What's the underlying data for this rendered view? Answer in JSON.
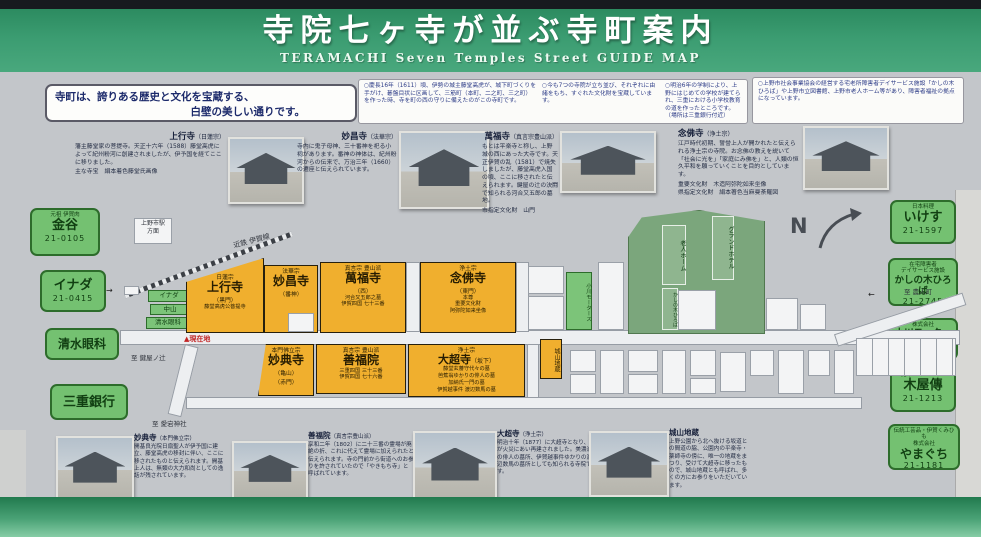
{
  "header": {
    "title": "寺院七ヶ寺が並ぶ寺町案内",
    "subtitle": "TERAMACHI Seven Temples Street GUIDE MAP"
  },
  "intro": {
    "line1": "寺町は、誇りある歴史と文化を宝蔵する、",
    "line2": "白壁の美しい通りです。"
  },
  "notes": {
    "note1": "○慶長16年（1611）頃、伊勢の城主藤堂高虎が、城下町づくりを手がけ、碁盤目状に区画して、三筋町（本町、二之町、三之町）を作った時、寺を町の西の守りに備えたのがこの寺町です。",
    "note2": "○今も7つの寺院が立ち並び、それぞれに由緒をもち、すぐれた文化財を宝蔵しています。",
    "note3": "○明治6年の学制により、上野にはじめての学校が建てられ、三重における小学校教育の道を作ったところです。（場所は三重銀行付近）",
    "note4": "○上野市社会事業協会の経営する宅老所障害者デイサービス施設「かしの木ひろば」や上野市立図書館、上野市老人ホーム等があり、障害者福祉の拠点になっています。"
  },
  "descriptions": [
    {
      "name": "上行寺",
      "sect": "（日蓮宗）",
      "body": "藩主藤堂家の菩提寺。天正十六年（1588）藤堂高虎によって紀州粉河に創建されましたが、伊予国を経てここに移りました。",
      "extra": "主な寺宝　絹本着色藤堂氏画像"
    },
    {
      "name": "妙昌寺",
      "sect": "（法華宗）",
      "body": "寺内に鬼子母神、三十番神を祀る小祠があります。番神の神体は、紀州粉河からの伝来で、万治三年（1660）の遷座と伝えられています。",
      "extra": ""
    },
    {
      "name": "萬福寺",
      "sect": "（真言宗豊山派）",
      "body": "もとは平楽寺と称し、上野城の西にあった大寺です。天正伊賀の乱（1581）で焼失しましたが、藤堂高虎入国の頃、ここに移されたと伝えられます。鍵屋の辻の決闘で知られる河合又五郎の墓地。",
      "extra": "市指定文化財　山門"
    },
    {
      "name": "念佛寺",
      "sect": "（浄土宗）",
      "body": "江戸時代初期、誓誉上人が開かれたと伝えられる浄土宗の寺院。お念佛の教えを説いて「社会に光を」「家庭にみ佛を」と、人類の恒久平和を願っていくことを目的としています。",
      "extra": "重要文化財　木造阿弥陀如来坐像\n県指定文化財　絹本著色当麻曼荼羅図"
    }
  ],
  "left_signs": [
    {
      "tag": "元祖 伊賀肉",
      "name": "金谷",
      "phone": "21-0105"
    },
    {
      "tag": "",
      "name": "イナダ",
      "phone": "21-0415"
    },
    {
      "tag": "",
      "name": "清水眼科",
      "phone": ""
    },
    {
      "tag": "",
      "name": "三重銀行",
      "phone": ""
    }
  ],
  "right_signs": [
    {
      "tag": "日本料理",
      "name": "いけす",
      "phone": "21-1597"
    },
    {
      "tag": "在宅障害者\nデイサービス施設",
      "name": "かしの木ひろば",
      "phone": "21-2745"
    },
    {
      "tag": "株式会社",
      "name": "小川モータース",
      "phone": "21-2625"
    },
    {
      "tag": "銘木・マンション",
      "name": "木屋傳",
      "phone": "21-1213"
    },
    {
      "tag": "伝統工芸品・伊賀くみひも\n株式会社",
      "name": "やまぐち",
      "phone": "21-1181"
    }
  ],
  "map": {
    "railway_label": "近鉄 伊賀線",
    "railway_dest": "上野市駅\n方面",
    "north": "N",
    "you_are_here": "▲現在地",
    "dir_west": "至 鍵屋ノ辻",
    "dir_south": "至 愛宕神社",
    "dir_east": "至 農人町",
    "blocks": {
      "jogyoji": {
        "sect": "日蓮宗",
        "name": "上行寺",
        "note": "（黒門）",
        "note2": "藤堂高虎公菩提寺"
      },
      "myoshoji": {
        "sect": "法華宗",
        "name": "妙昌寺",
        "note": "（番神）",
        "note2": ""
      },
      "manpukuji": {
        "sect": "真言宗 豊山派",
        "name": "萬福寺",
        "note": "（西）",
        "note2": "河合又五郎之墓\n伊賀四国 七十三番"
      },
      "nenbutsuji": {
        "sect": "浄土宗",
        "name": "念佛寺",
        "note": "（東門）",
        "note2": "本尊\n重要文化財\n阿弥陀如来坐像"
      },
      "myotenji": {
        "sect": "本門佛立宗",
        "name": "妙典寺",
        "note": "（亀山）",
        "note2": "（赤門）"
      },
      "zenpukuin": {
        "sect": "真言宗 豊山派",
        "name": "善福院",
        "note": "（京殿）",
        "note2": "三重四国 三十三番\n伊賀四国 七十六番"
      },
      "daichoji": {
        "sect": "浄土宗",
        "name": "大超寺",
        "note": "（坂下）",
        "note2": "藤堂玄蕃守代々の墓\n芭蕉翁ゆかりの俳人の墓\n加納氏一門の墓\n伊賀越事件 渡辺数馬の墓"
      }
    },
    "small_blocks": {
      "shiroyama": "城山地蔵",
      "inada": "イナダ",
      "nakayama": "中山",
      "shimizu": "清水眼科",
      "ogawa": "小川モータース"
    },
    "facilities": {
      "home": "老人ホーム",
      "hotel": "グランドホテル",
      "kashinoki": "かしの木ひろば"
    }
  },
  "bottom_items": [
    {
      "name": "妙典寺",
      "sect": "（本門佛立宗）",
      "body": "開基良光院日扇聖人が伊予国に建立、藤堂高虎の移封に伴い、ここに移されたものと伝えられます。開基上人は、無類の大力和尚としての逸話が残されています。"
    },
    {
      "name": "善福院",
      "sect": "（真言宗豊山派）",
      "body": "享和二年（1802）に二十三番の霊場が廃絶の折、これに代えて霊場に加えられたと伝えられます。寺の門前から街道へのお参りを許されていたので「やきもち寺」と呼ばれています。"
    },
    {
      "name": "大超寺",
      "sect": "（浄土宗）",
      "body": "明治十年（1877）に大超寺となり、寺が火災にあい再建されました。美濃派の俳人の墓所、伊賀越事件ゆかりの渡辺数馬の墓所としても知られる寺院です。"
    },
    {
      "name": "城山地蔵",
      "sect": "",
      "body": "上野公園から北へ抜ける坂道との間道の脇、公園内の平楽寺・薬師寺の傍に、唯一の地蔵をまつり、受けて大超寺に移ったもので、城山地蔵とも呼ばれ、多くの方にお参りをいただいています。"
    }
  ]
}
